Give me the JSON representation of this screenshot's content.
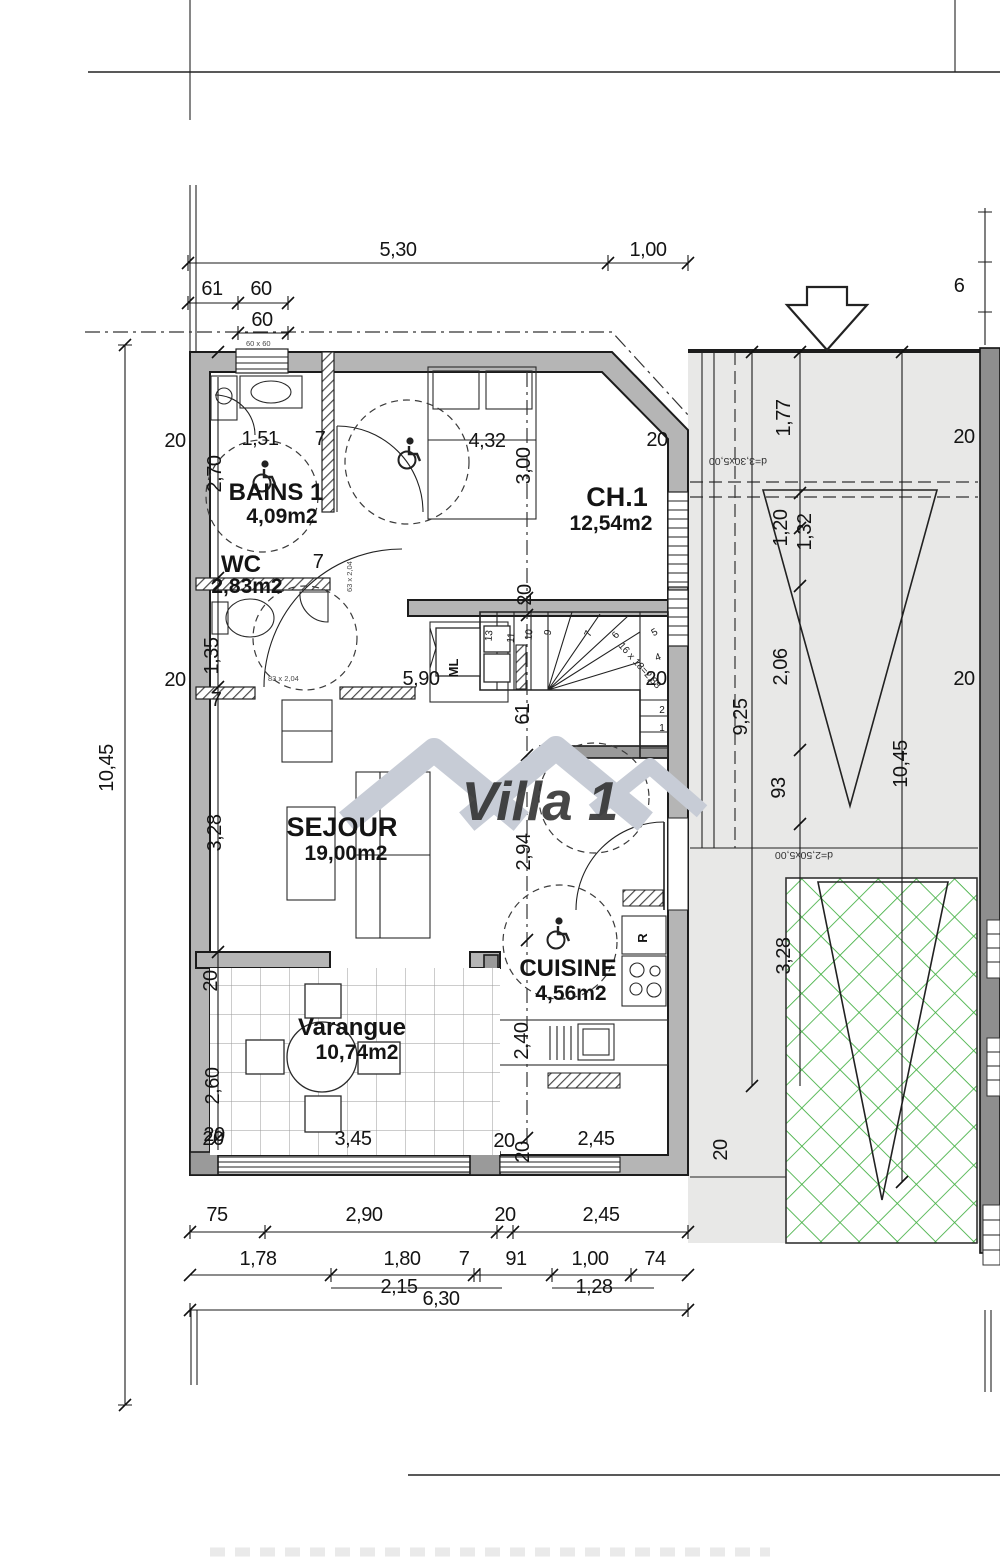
{
  "plan": {
    "watermark": {
      "title": "Villa 1"
    },
    "rooms": {
      "bains": {
        "name": "BAINS 1",
        "area": "4,09m2"
      },
      "wc": {
        "name": "WC",
        "area": "2,83m2"
      },
      "ch1": {
        "name": "CH.1",
        "area": "12,54m2"
      },
      "sejour": {
        "name": "SEJOUR",
        "area": "19,00m2"
      },
      "cuisine": {
        "name": "CUISINE",
        "area": "4,56m2"
      },
      "varangue": {
        "name": "Varangue",
        "area": "10,74m2"
      }
    },
    "texts": {
      "ml": "ML",
      "fridge": "R",
      "stair_note": "16 x 18=2,88",
      "parking_drive": "d=3,30x5,00",
      "parking_green": "d=2,50x5,00",
      "window_tag": "60 x 60",
      "door_tag": "63 x 2,04",
      "door_tag2": "83 x 2,04"
    },
    "colors": {
      "wall_fill": "#b5b5b5",
      "wall_line": "#1c1c1c",
      "driveway": "#e8e8e7",
      "neighbor_wall": "#8e8e8e",
      "green_hatch": "#44b044",
      "watermark_logo": "#c7ccd6",
      "text": "#141414"
    },
    "dim_labels": [
      {
        "t": "5,30",
        "x": 398,
        "y": 256
      },
      {
        "t": "1,00",
        "x": 648,
        "y": 256
      },
      {
        "t": "61",
        "x": 212,
        "y": 295
      },
      {
        "t": "60",
        "x": 261,
        "y": 295
      },
      {
        "t": "60",
        "x": 262,
        "y": 326
      },
      {
        "t": "10,45",
        "x": 113,
        "y": 768,
        "r": -90
      },
      {
        "t": "20",
        "x": 175,
        "y": 447
      },
      {
        "t": "20",
        "x": 175,
        "y": 686
      },
      {
        "t": "2,70",
        "x": 221,
        "y": 474,
        "r": -90
      },
      {
        "t": "1,35",
        "x": 218,
        "y": 656,
        "r": -90
      },
      {
        "t": "3,28",
        "x": 221,
        "y": 833,
        "r": -90
      },
      {
        "t": "20",
        "x": 217,
        "y": 981,
        "r": -90
      },
      {
        "t": "2,60",
        "x": 219,
        "y": 1086,
        "r": -90
      },
      {
        "t": "20",
        "x": 214,
        "y": 1141
      },
      {
        "t": "1,51",
        "x": 260,
        "y": 445
      },
      {
        "t": "7",
        "x": 320,
        "y": 445
      },
      {
        "t": "4,32",
        "x": 487,
        "y": 447
      },
      {
        "t": "20",
        "x": 657,
        "y": 446
      },
      {
        "t": "3,00",
        "x": 530,
        "y": 466,
        "r": -90
      },
      {
        "t": "7",
        "x": 318,
        "y": 568
      },
      {
        "t": "7",
        "x": 216,
        "y": 706
      },
      {
        "t": "20",
        "x": 531,
        "y": 595,
        "r": -90
      },
      {
        "t": "61",
        "x": 529,
        "y": 714,
        "r": -90
      },
      {
        "t": "2,94",
        "x": 530,
        "y": 852,
        "r": -90
      },
      {
        "t": "2,40",
        "x": 528,
        "y": 1041,
        "r": -90
      },
      {
        "t": "20",
        "x": 529,
        "y": 1152,
        "r": -90
      },
      {
        "t": "5,90",
        "x": 421,
        "y": 685
      },
      {
        "t": "20",
        "x": 656,
        "y": 685
      },
      {
        "t": "1,77",
        "x": 790,
        "y": 418,
        "r": -90
      },
      {
        "t": "1,20",
        "x": 787,
        "y": 528,
        "r": -90
      },
      {
        "t": "1,32",
        "x": 811,
        "y": 532,
        "r": -90
      },
      {
        "t": "2,06",
        "x": 787,
        "y": 667,
        "r": -90
      },
      {
        "t": "93",
        "x": 785,
        "y": 788,
        "r": -90
      },
      {
        "t": "9,25",
        "x": 747,
        "y": 717,
        "r": -90
      },
      {
        "t": "10,45",
        "x": 907,
        "y": 764,
        "r": -90
      },
      {
        "t": "3,28",
        "x": 790,
        "y": 956,
        "r": -90
      },
      {
        "t": "20",
        "x": 727,
        "y": 1150,
        "r": -90
      },
      {
        "t": "20",
        "x": 964,
        "y": 443
      },
      {
        "t": "20",
        "x": 964,
        "y": 685
      },
      {
        "t": "6",
        "x": 959,
        "y": 292
      },
      {
        "t": "20",
        "x": 213,
        "y": 1145
      },
      {
        "t": "3,45",
        "x": 353,
        "y": 1145
      },
      {
        "t": "20",
        "x": 504,
        "y": 1147
      },
      {
        "t": "2,45",
        "x": 596,
        "y": 1145
      },
      {
        "t": "75",
        "x": 217,
        "y": 1221
      },
      {
        "t": "2,90",
        "x": 364,
        "y": 1221
      },
      {
        "t": "20",
        "x": 505,
        "y": 1221
      },
      {
        "t": "2,45",
        "x": 601,
        "y": 1221
      },
      {
        "t": "1,78",
        "x": 258,
        "y": 1265
      },
      {
        "t": "1,80",
        "x": 402,
        "y": 1265
      },
      {
        "t": "7",
        "x": 464,
        "y": 1265
      },
      {
        "t": "91",
        "x": 516,
        "y": 1265
      },
      {
        "t": "1,00",
        "x": 590,
        "y": 1265
      },
      {
        "t": "74",
        "x": 655,
        "y": 1265
      },
      {
        "t": "2,15",
        "x": 399,
        "y": 1293
      },
      {
        "t": "6,30",
        "x": 441,
        "y": 1305
      },
      {
        "t": "1,28",
        "x": 594,
        "y": 1293
      }
    ],
    "stair_steps": [
      {
        "t": "1",
        "x": 662,
        "y": 731,
        "r": 0
      },
      {
        "t": "2",
        "x": 662,
        "y": 713,
        "r": 0
      },
      {
        "t": "4",
        "x": 659,
        "y": 660,
        "r": -20
      },
      {
        "t": "5",
        "x": 656,
        "y": 635,
        "r": -30
      },
      {
        "t": "6",
        "x": 618,
        "y": 637,
        "r": -50
      },
      {
        "t": "7",
        "x": 591,
        "y": 635,
        "r": -65
      },
      {
        "t": "9",
        "x": 551,
        "y": 633,
        "r": -80
      },
      {
        "t": "10",
        "x": 532,
        "y": 635,
        "r": -85
      },
      {
        "t": "11",
        "x": 514,
        "y": 638,
        "r": -85
      },
      {
        "t": "13",
        "x": 492,
        "y": 636,
        "r": -85
      }
    ]
  }
}
